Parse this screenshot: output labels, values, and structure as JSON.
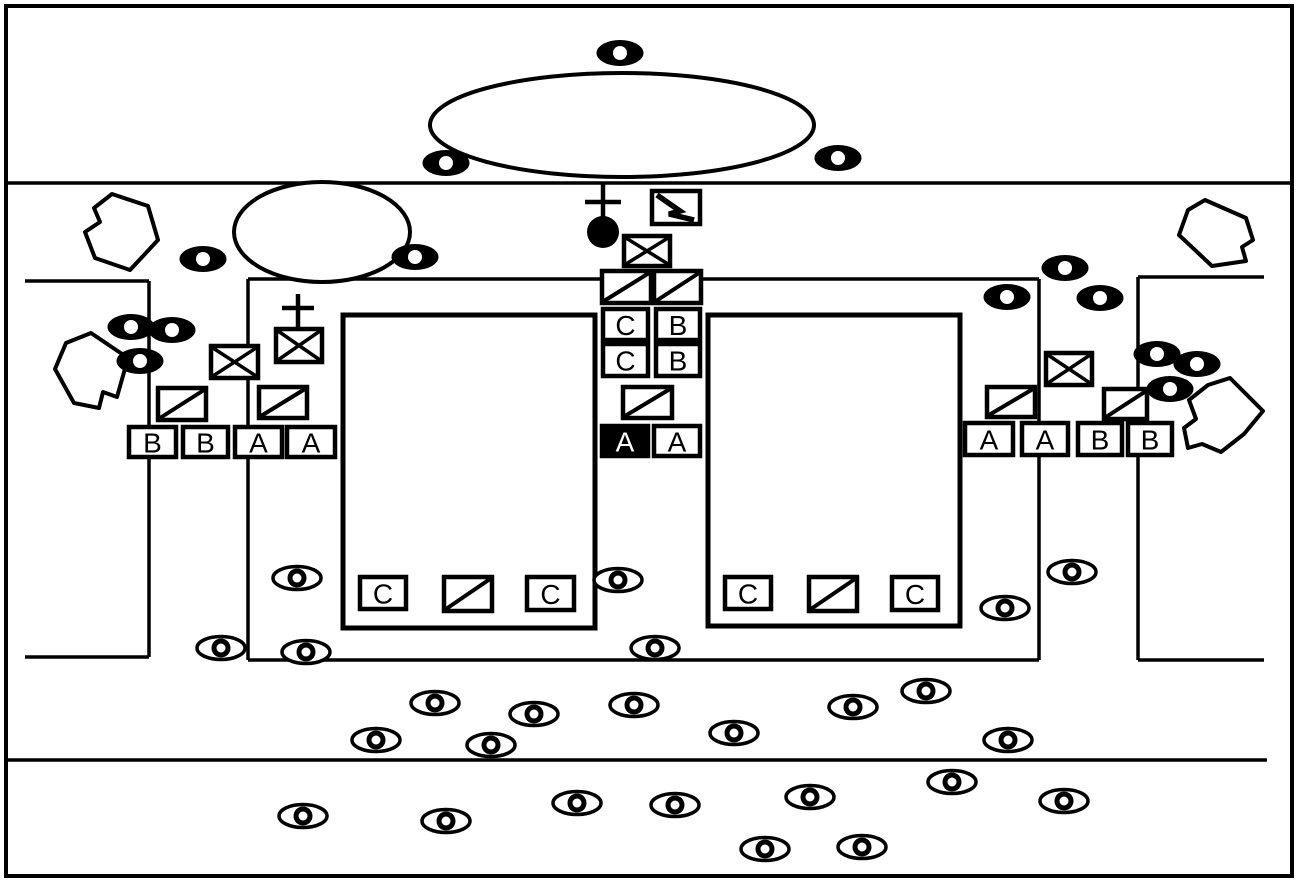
{
  "canvas": {
    "width": 1299,
    "height": 882,
    "background": "#ffffff",
    "ink": "#000000"
  },
  "border": {
    "x": 6,
    "y": 6,
    "width": 1286,
    "height": 870,
    "stroke_width": 4
  },
  "lines": [
    {
      "name": "road-upper",
      "x1": 6,
      "y1": 183,
      "x2": 1293,
      "y2": 183,
      "stroke_width": 3.5
    },
    {
      "name": "road-lower",
      "x1": 6,
      "y1": 760,
      "x2": 1267,
      "y2": 760,
      "stroke_width": 3.5
    },
    {
      "name": "left-bracket-top",
      "x1": 25,
      "y1": 281,
      "x2": 149,
      "y2": 281,
      "stroke_width": 3.5
    },
    {
      "name": "left-bracket-side",
      "x1": 149,
      "y1": 281,
      "x2": 149,
      "y2": 657,
      "stroke_width": 3.5
    },
    {
      "name": "left-bracket-bottom",
      "x1": 25,
      "y1": 657,
      "x2": 149,
      "y2": 657,
      "stroke_width": 3.5
    },
    {
      "name": "enclosure-top",
      "x1": 248,
      "y1": 279,
      "x2": 1039,
      "y2": 279,
      "stroke_width": 3.5
    },
    {
      "name": "enclosure-left",
      "x1": 248,
      "y1": 279,
      "x2": 248,
      "y2": 660,
      "stroke_width": 3.5
    },
    {
      "name": "enclosure-bottom",
      "x1": 248,
      "y1": 660,
      "x2": 1039,
      "y2": 660,
      "stroke_width": 3.5
    },
    {
      "name": "enclosure-right",
      "x1": 1039,
      "y1": 279,
      "x2": 1039,
      "y2": 660,
      "stroke_width": 3.5
    },
    {
      "name": "right-bracket-top",
      "x1": 1138,
      "y1": 277,
      "x2": 1264,
      "y2": 277,
      "stroke_width": 3.5
    },
    {
      "name": "right-bracket-side",
      "x1": 1138,
      "y1": 277,
      "x2": 1138,
      "y2": 660,
      "stroke_width": 3.5
    },
    {
      "name": "right-bracket-bottom",
      "x1": 1138,
      "y1": 660,
      "x2": 1264,
      "y2": 660,
      "stroke_width": 3.5
    }
  ],
  "courts": [
    {
      "name": "left-court",
      "x": 343,
      "y": 315,
      "width": 252,
      "height": 313,
      "stroke_width": 5
    },
    {
      "name": "right-court",
      "x": 708,
      "y": 315,
      "width": 252,
      "height": 311,
      "stroke_width": 5
    }
  ],
  "mounds": [
    {
      "name": "large-oval",
      "cx": 622,
      "cy": 125,
      "rx": 192,
      "ry": 52,
      "stroke_width": 4
    },
    {
      "name": "small-oval",
      "cx": 322,
      "cy": 232,
      "rx": 88,
      "ry": 50,
      "stroke_width": 4
    }
  ],
  "rocks": [
    {
      "name": "rock-top-left",
      "points": [
        [
          112,
          194
        ],
        [
          148,
          206
        ],
        [
          158,
          240
        ],
        [
          130,
          270
        ],
        [
          95,
          258
        ],
        [
          85,
          232
        ],
        [
          100,
          222
        ],
        [
          94,
          208
        ]
      ]
    },
    {
      "name": "rock-bottom-left",
      "points": [
        [
          91,
          333
        ],
        [
          128,
          358
        ],
        [
          117,
          397
        ],
        [
          103,
          392
        ],
        [
          99,
          408
        ],
        [
          74,
          403
        ],
        [
          55,
          369
        ],
        [
          66,
          343
        ]
      ]
    },
    {
      "name": "rock-top-right",
      "points": [
        [
          1205,
          200
        ],
        [
          1246,
          218
        ],
        [
          1253,
          240
        ],
        [
          1242,
          247
        ],
        [
          1246,
          261
        ],
        [
          1212,
          266
        ],
        [
          1179,
          235
        ],
        [
          1188,
          210
        ]
      ]
    },
    {
      "name": "rock-bottom-right",
      "points": [
        [
          1230,
          378
        ],
        [
          1263,
          411
        ],
        [
          1244,
          434
        ],
        [
          1221,
          452
        ],
        [
          1202,
          444
        ],
        [
          1188,
          448
        ],
        [
          1184,
          428
        ],
        [
          1196,
          419
        ],
        [
          1189,
          400
        ],
        [
          1208,
          385
        ]
      ]
    }
  ],
  "letter_boxes": [
    {
      "x": 129,
      "y": 427,
      "w": 47,
      "h": 30,
      "label": "B",
      "filled": false
    },
    {
      "x": 183,
      "y": 427,
      "w": 45,
      "h": 30,
      "label": "B",
      "filled": false
    },
    {
      "x": 235,
      "y": 427,
      "w": 47,
      "h": 30,
      "label": "A",
      "filled": false
    },
    {
      "x": 287,
      "y": 427,
      "w": 48,
      "h": 30,
      "label": "A",
      "filled": false
    },
    {
      "x": 965,
      "y": 423,
      "w": 48,
      "h": 32,
      "label": "A",
      "filled": false
    },
    {
      "x": 1022,
      "y": 423,
      "w": 46,
      "h": 32,
      "label": "A",
      "filled": false
    },
    {
      "x": 1078,
      "y": 423,
      "w": 44,
      "h": 32,
      "label": "B",
      "filled": false
    },
    {
      "x": 1128,
      "y": 423,
      "w": 44,
      "h": 32,
      "label": "B",
      "filled": false
    },
    {
      "x": 603,
      "y": 309,
      "w": 45,
      "h": 31,
      "label": "C",
      "filled": false
    },
    {
      "x": 656,
      "y": 309,
      "w": 44,
      "h": 31,
      "label": "B",
      "filled": false
    },
    {
      "x": 603,
      "y": 344,
      "w": 45,
      "h": 32,
      "label": "C",
      "filled": false
    },
    {
      "x": 656,
      "y": 344,
      "w": 44,
      "h": 32,
      "label": "B",
      "filled": false
    },
    {
      "x": 602,
      "y": 426,
      "w": 46,
      "h": 30,
      "label": "A",
      "filled": true
    },
    {
      "x": 654,
      "y": 426,
      "w": 46,
      "h": 30,
      "label": "A",
      "filled": false
    },
    {
      "x": 360,
      "y": 577,
      "w": 46,
      "h": 32,
      "label": "C",
      "filled": false
    },
    {
      "x": 527,
      "y": 577,
      "w": 47,
      "h": 33,
      "label": "C",
      "filled": false
    },
    {
      "x": 725,
      "y": 577,
      "w": 46,
      "h": 32,
      "label": "C",
      "filled": false
    },
    {
      "x": 892,
      "y": 577,
      "w": 46,
      "h": 33,
      "label": "C",
      "filled": false
    }
  ],
  "slash_boxes": [
    {
      "x": 602,
      "y": 271,
      "w": 49,
      "h": 32,
      "overshoot": false
    },
    {
      "x": 654,
      "y": 271,
      "w": 47,
      "h": 32,
      "overshoot": false
    },
    {
      "x": 623,
      "y": 387,
      "w": 49,
      "h": 31,
      "overshoot": false
    },
    {
      "x": 158,
      "y": 388,
      "w": 48,
      "h": 32,
      "overshoot": false
    },
    {
      "x": 259,
      "y": 387,
      "w": 48,
      "h": 31,
      "overshoot": false
    },
    {
      "x": 987,
      "y": 387,
      "w": 48,
      "h": 30,
      "overshoot": false
    },
    {
      "x": 1104,
      "y": 389,
      "w": 43,
      "h": 30,
      "overshoot": true
    },
    {
      "x": 444,
      "y": 577,
      "w": 48,
      "h": 34,
      "overshoot": false
    },
    {
      "x": 809,
      "y": 577,
      "w": 48,
      "h": 34,
      "overshoot": false
    }
  ],
  "crossed_boxes": [
    {
      "x": 624,
      "y": 236,
      "w": 46,
      "h": 30
    },
    {
      "x": 276,
      "y": 329,
      "w": 46,
      "h": 33
    },
    {
      "x": 211,
      "y": 346,
      "w": 47,
      "h": 32
    },
    {
      "x": 1046,
      "y": 353,
      "w": 46,
      "h": 32
    }
  ],
  "lightning_boxes": [
    {
      "x": 652,
      "y": 191,
      "w": 48,
      "h": 33,
      "bolt": [
        [
          657,
          195
        ],
        [
          680,
          211
        ],
        [
          669,
          214
        ],
        [
          694,
          220
        ]
      ]
    }
  ],
  "crosses": [
    {
      "cx": 603,
      "bar_y": 202,
      "bar_half": 18,
      "stem_top": 184,
      "stem_bottom": 217,
      "stroke_width": 4.5
    },
    {
      "cx": 298,
      "bar_y": 308,
      "bar_half": 16,
      "stem_top": 294,
      "stem_bottom": 330,
      "stroke_width": 4.5
    }
  ],
  "filled_circles": [
    {
      "cx": 603,
      "cy": 232,
      "r": 16
    }
  ],
  "eyes": {
    "filled_style": {
      "rx": 23.5,
      "ry": 13,
      "hole_r": 7
    },
    "outlined_style": {
      "rx": 24,
      "ry": 11.5,
      "stroke_width": 3.5,
      "ring_r": 9.5,
      "hole_r": 4.5
    },
    "filled": [
      [
        620,
        53
      ],
      [
        446,
        163
      ],
      [
        838,
        158
      ],
      [
        203,
        259
      ],
      [
        415,
        257
      ],
      [
        131,
        327
      ],
      [
        172,
        330
      ],
      [
        140,
        361
      ],
      [
        1065,
        268
      ],
      [
        1007,
        297
      ],
      [
        1100,
        298
      ],
      [
        1157,
        354
      ],
      [
        1197,
        364
      ],
      [
        1170,
        389
      ]
    ],
    "outlined": [
      [
        297,
        578
      ],
      [
        618,
        580
      ],
      [
        1072,
        572
      ],
      [
        1005,
        608
      ],
      [
        221,
        648
      ],
      [
        306,
        652
      ],
      [
        655,
        648
      ],
      [
        435,
        703
      ],
      [
        534,
        714
      ],
      [
        634,
        705
      ],
      [
        376,
        740
      ],
      [
        491,
        745
      ],
      [
        734,
        733
      ],
      [
        853,
        707
      ],
      [
        926,
        691
      ],
      [
        1008,
        740
      ],
      [
        303,
        816
      ],
      [
        446,
        821
      ],
      [
        577,
        803
      ],
      [
        675,
        805
      ],
      [
        765,
        849
      ],
      [
        810,
        797
      ],
      [
        862,
        847
      ],
      [
        952,
        782
      ],
      [
        1064,
        801
      ]
    ]
  },
  "box_style": {
    "stroke_width": 4.5,
    "font_size": 28
  }
}
